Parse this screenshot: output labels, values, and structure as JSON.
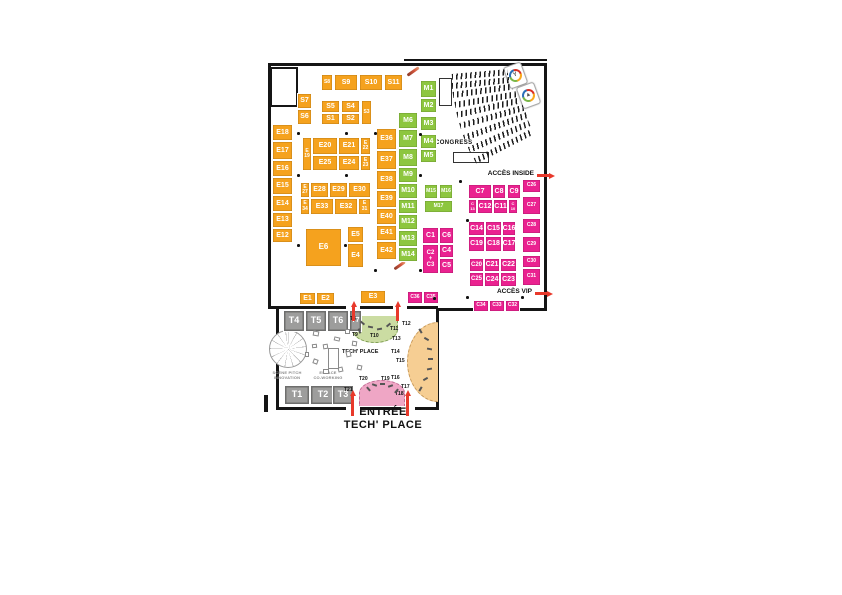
{
  "labels": {
    "congress": "CONGRESS",
    "acces_inside": "ACCÈS INSIDE",
    "acces_vip": "ACCÈS VIP",
    "tech_place": "TECH' PLACE",
    "scene_line1": "SCÈNE PITCH",
    "scene_line2": "INNOVATION",
    "cowork_line1": "ESPACE",
    "cowork_line2": "CO-WORKING",
    "entree_line1": "ENTRÉE",
    "entree_line2": "TECH' PLACE"
  },
  "icons": {
    "badge1": "Y",
    "badge2": "▲"
  },
  "colors": {
    "booth_orange": "#F5A21E",
    "booth_green": "#8DC63F",
    "booth_pink": "#EA2290",
    "booth_gray": "#9D9D9C",
    "zone_pale_green": "#CBDCA2",
    "zone_pale_orange": "#F6CE93",
    "zone_pale_pink": "#EFA6C5",
    "arrow_red": "#E8392B"
  },
  "booths": [
    {
      "id": "S8",
      "x": 321,
      "y": 74,
      "w": 12,
      "h": 17,
      "c": "orange",
      "lines": [
        "S8"
      ],
      "fs": 5
    },
    {
      "id": "S9",
      "label": "S9",
      "x": 334,
      "y": 74,
      "w": 24,
      "h": 17,
      "c": "orange"
    },
    {
      "id": "S10",
      "label": "S10",
      "x": 359,
      "y": 74,
      "w": 24,
      "h": 17,
      "c": "orange"
    },
    {
      "id": "S11",
      "label": "S11",
      "x": 384,
      "y": 74,
      "w": 19,
      "h": 17,
      "c": "orange"
    },
    {
      "id": "S7",
      "label": "S7",
      "x": 297,
      "y": 93,
      "w": 15,
      "h": 16,
      "c": "orange"
    },
    {
      "id": "S6",
      "label": "S6",
      "x": 297,
      "y": 109,
      "w": 15,
      "h": 16,
      "c": "orange"
    },
    {
      "id": "S5",
      "label": "S5",
      "x": 321,
      "y": 100,
      "w": 19,
      "h": 13,
      "c": "orange"
    },
    {
      "id": "S4",
      "label": "S4",
      "x": 341,
      "y": 100,
      "w": 19,
      "h": 13,
      "c": "orange"
    },
    {
      "id": "S3",
      "x": 361,
      "y": 100,
      "w": 11,
      "h": 25,
      "c": "orange",
      "lines": [
        "S3"
      ],
      "fs": 5
    },
    {
      "id": "S1",
      "label": "S1",
      "x": 321,
      "y": 113,
      "w": 19,
      "h": 12,
      "c": "orange"
    },
    {
      "id": "S2",
      "label": "S2",
      "x": 341,
      "y": 113,
      "w": 19,
      "h": 12,
      "c": "orange"
    },
    {
      "id": "E18",
      "label": "E18",
      "x": 272,
      "y": 124,
      "w": 21,
      "h": 17,
      "c": "orange"
    },
    {
      "id": "E17",
      "label": "E17",
      "x": 272,
      "y": 141,
      "w": 21,
      "h": 19,
      "c": "orange"
    },
    {
      "id": "E16",
      "label": "E16",
      "x": 272,
      "y": 160,
      "w": 21,
      "h": 17,
      "c": "orange"
    },
    {
      "id": "E15",
      "label": "E15",
      "x": 272,
      "y": 177,
      "w": 21,
      "h": 18,
      "c": "orange"
    },
    {
      "id": "E14",
      "label": "E14",
      "x": 272,
      "y": 195,
      "w": 21,
      "h": 17,
      "c": "orange"
    },
    {
      "id": "E13",
      "label": "E13",
      "x": 272,
      "y": 212,
      "w": 21,
      "h": 16,
      "c": "orange"
    },
    {
      "id": "E12",
      "label": "E12",
      "x": 272,
      "y": 228,
      "w": 21,
      "h": 15,
      "c": "orange"
    },
    {
      "id": "E19",
      "x": 302,
      "y": 137,
      "w": 10,
      "h": 34,
      "c": "orange",
      "lines": [
        "E",
        "19"
      ],
      "fs": 5
    },
    {
      "id": "E20",
      "label": "E20",
      "x": 312,
      "y": 137,
      "w": 26,
      "h": 18,
      "c": "orange"
    },
    {
      "id": "E21",
      "label": "E21",
      "x": 338,
      "y": 137,
      "w": 22,
      "h": 18,
      "c": "orange"
    },
    {
      "id": "E22",
      "x": 360,
      "y": 137,
      "w": 11,
      "h": 18,
      "c": "orange",
      "lines": [
        "E",
        "22"
      ],
      "fs": 5
    },
    {
      "id": "E25",
      "label": "E25",
      "x": 312,
      "y": 155,
      "w": 26,
      "h": 16,
      "c": "orange"
    },
    {
      "id": "E24",
      "label": "E24",
      "x": 338,
      "y": 155,
      "w": 22,
      "h": 16,
      "c": "orange"
    },
    {
      "id": "E23",
      "x": 360,
      "y": 155,
      "w": 11,
      "h": 16,
      "c": "orange",
      "lines": [
        "E",
        "23"
      ],
      "fs": 5
    },
    {
      "id": "E27",
      "x": 300,
      "y": 182,
      "w": 10,
      "h": 16,
      "c": "orange",
      "lines": [
        "E",
        "27"
      ],
      "fs": 5
    },
    {
      "id": "E28",
      "label": "E28",
      "x": 310,
      "y": 182,
      "w": 19,
      "h": 16,
      "c": "orange"
    },
    {
      "id": "E29",
      "label": "E29",
      "x": 329,
      "y": 182,
      "w": 19,
      "h": 16,
      "c": "orange"
    },
    {
      "id": "E30",
      "label": "E30",
      "x": 348,
      "y": 182,
      "w": 23,
      "h": 16,
      "c": "orange"
    },
    {
      "id": "E34",
      "x": 300,
      "y": 198,
      "w": 10,
      "h": 17,
      "c": "orange",
      "lines": [
        "E",
        "34"
      ],
      "fs": 5
    },
    {
      "id": "E33",
      "label": "E33",
      "x": 310,
      "y": 198,
      "w": 24,
      "h": 17,
      "c": "orange"
    },
    {
      "id": "E32",
      "label": "E32",
      "x": 334,
      "y": 198,
      "w": 24,
      "h": 17,
      "c": "orange"
    },
    {
      "id": "E31",
      "x": 358,
      "y": 198,
      "w": 13,
      "h": 17,
      "c": "orange",
      "lines": [
        "E",
        "31"
      ],
      "fs": 5
    },
    {
      "id": "E6",
      "label": "E6",
      "x": 305,
      "y": 228,
      "w": 37,
      "h": 39,
      "c": "orange",
      "fs": 8
    },
    {
      "id": "E5",
      "label": "E5",
      "x": 347,
      "y": 226,
      "w": 17,
      "h": 17,
      "c": "orange"
    },
    {
      "id": "E4",
      "label": "E4",
      "x": 347,
      "y": 243,
      "w": 17,
      "h": 25,
      "c": "orange"
    },
    {
      "id": "E36",
      "label": "E36",
      "x": 376,
      "y": 128,
      "w": 21,
      "h": 22,
      "c": "orange"
    },
    {
      "id": "E37",
      "label": "E37",
      "x": 376,
      "y": 150,
      "w": 21,
      "h": 20,
      "c": "orange"
    },
    {
      "id": "E38",
      "label": "E38",
      "x": 376,
      "y": 170,
      "w": 21,
      "h": 20,
      "c": "orange"
    },
    {
      "id": "E39",
      "label": "E39",
      "x": 376,
      "y": 190,
      "w": 21,
      "h": 18,
      "c": "orange"
    },
    {
      "id": "E40",
      "label": "E40",
      "x": 376,
      "y": 208,
      "w": 21,
      "h": 17,
      "c": "orange"
    },
    {
      "id": "E41",
      "label": "E41",
      "x": 376,
      "y": 225,
      "w": 21,
      "h": 16,
      "c": "orange"
    },
    {
      "id": "E42",
      "label": "E42",
      "x": 376,
      "y": 241,
      "w": 21,
      "h": 19,
      "c": "orange"
    },
    {
      "id": "E1",
      "label": "E1",
      "x": 299,
      "y": 292,
      "w": 17,
      "h": 13,
      "c": "orange"
    },
    {
      "id": "E2",
      "label": "E2",
      "x": 316,
      "y": 292,
      "w": 19,
      "h": 13,
      "c": "orange"
    },
    {
      "id": "E3",
      "label": "E3",
      "x": 360,
      "y": 290,
      "w": 26,
      "h": 14,
      "c": "orange"
    },
    {
      "id": "M6",
      "label": "M6",
      "x": 398,
      "y": 112,
      "w": 20,
      "h": 17,
      "c": "green"
    },
    {
      "id": "M7",
      "label": "M7",
      "x": 398,
      "y": 129,
      "w": 20,
      "h": 19,
      "c": "green"
    },
    {
      "id": "M8",
      "label": "M8",
      "x": 398,
      "y": 148,
      "w": 20,
      "h": 19,
      "c": "green"
    },
    {
      "id": "M9",
      "label": "M9",
      "x": 398,
      "y": 167,
      "w": 20,
      "h": 16,
      "c": "green"
    },
    {
      "id": "M10",
      "label": "M10",
      "x": 398,
      "y": 183,
      "w": 20,
      "h": 16,
      "c": "green"
    },
    {
      "id": "M11",
      "label": "M11",
      "x": 398,
      "y": 199,
      "w": 20,
      "h": 15,
      "c": "green"
    },
    {
      "id": "M12",
      "label": "M12",
      "x": 398,
      "y": 214,
      "w": 20,
      "h": 16,
      "c": "green"
    },
    {
      "id": "M13",
      "label": "M13",
      "x": 398,
      "y": 230,
      "w": 20,
      "h": 17,
      "c": "green"
    },
    {
      "id": "M14",
      "label": "M14",
      "x": 398,
      "y": 247,
      "w": 20,
      "h": 15,
      "c": "green"
    },
    {
      "id": "M1",
      "label": "M1",
      "x": 420,
      "y": 80,
      "w": 17,
      "h": 18,
      "c": "green"
    },
    {
      "id": "M2",
      "label": "M2",
      "x": 420,
      "y": 98,
      "w": 17,
      "h": 15,
      "c": "green"
    },
    {
      "id": "M3",
      "label": "M3",
      "x": 420,
      "y": 116,
      "w": 17,
      "h": 15,
      "c": "green"
    },
    {
      "id": "M4",
      "label": "M4",
      "x": 420,
      "y": 134,
      "w": 17,
      "h": 15,
      "c": "green"
    },
    {
      "id": "M5",
      "label": "M5",
      "x": 420,
      "y": 149,
      "w": 17,
      "h": 14,
      "c": "green"
    },
    {
      "id": "M15",
      "label": "M15",
      "x": 424,
      "y": 184,
      "w": 14,
      "h": 15,
      "c": "green",
      "fs": 5
    },
    {
      "id": "M16",
      "label": "M16",
      "x": 439,
      "y": 184,
      "w": 14,
      "h": 15,
      "c": "green",
      "fs": 5
    },
    {
      "id": "M17",
      "label": "M17",
      "x": 424,
      "y": 200,
      "w": 29,
      "h": 13,
      "c": "green",
      "fs": 5
    },
    {
      "id": "C7",
      "label": "C7",
      "x": 468,
      "y": 184,
      "w": 24,
      "h": 15,
      "c": "pink"
    },
    {
      "id": "C8",
      "label": "C8",
      "x": 492,
      "y": 184,
      "w": 14,
      "h": 15,
      "c": "pink"
    },
    {
      "id": "C9",
      "label": "C9",
      "x": 507,
      "y": 184,
      "w": 14,
      "h": 15,
      "c": "pink"
    },
    {
      "id": "C13",
      "x": 468,
      "y": 199,
      "w": 9,
      "h": 15,
      "c": "pink",
      "lines": [
        "C",
        "13"
      ],
      "fs": 4
    },
    {
      "id": "C12",
      "label": "C12",
      "x": 477,
      "y": 199,
      "w": 16,
      "h": 15,
      "c": "pink"
    },
    {
      "id": "C11",
      "label": "C11",
      "x": 493,
      "y": 199,
      "w": 15,
      "h": 15,
      "c": "pink"
    },
    {
      "id": "C10",
      "x": 508,
      "y": 199,
      "w": 10,
      "h": 15,
      "c": "pink",
      "lines": [
        "C",
        "10"
      ],
      "fs": 4
    },
    {
      "id": "C14",
      "label": "C14",
      "x": 468,
      "y": 221,
      "w": 17,
      "h": 15,
      "c": "pink"
    },
    {
      "id": "C15",
      "label": "C15",
      "x": 485,
      "y": 221,
      "w": 17,
      "h": 15,
      "c": "pink"
    },
    {
      "id": "C16",
      "label": "C16",
      "x": 502,
      "y": 221,
      "w": 14,
      "h": 15,
      "c": "pink"
    },
    {
      "id": "C19",
      "label": "C19",
      "x": 468,
      "y": 236,
      "w": 17,
      "h": 16,
      "c": "pink"
    },
    {
      "id": "C18",
      "label": "C18",
      "x": 485,
      "y": 236,
      "w": 17,
      "h": 16,
      "c": "pink"
    },
    {
      "id": "C17",
      "label": "C17",
      "x": 502,
      "y": 236,
      "w": 14,
      "h": 16,
      "c": "pink"
    },
    {
      "id": "C20",
      "label": "C20",
      "x": 469,
      "y": 258,
      "w": 15,
      "h": 14,
      "c": "pink",
      "fs": 6
    },
    {
      "id": "C21",
      "label": "C21",
      "x": 484,
      "y": 258,
      "w": 16,
      "h": 14,
      "c": "pink"
    },
    {
      "id": "C22",
      "label": "C22",
      "x": 500,
      "y": 258,
      "w": 17,
      "h": 14,
      "c": "pink"
    },
    {
      "id": "C25",
      "label": "C25",
      "x": 469,
      "y": 272,
      "w": 15,
      "h": 15,
      "c": "pink",
      "fs": 6
    },
    {
      "id": "C24",
      "label": "C24",
      "x": 484,
      "y": 272,
      "w": 16,
      "h": 15,
      "c": "pink"
    },
    {
      "id": "C23",
      "label": "C23",
      "x": 500,
      "y": 272,
      "w": 17,
      "h": 15,
      "c": "pink"
    },
    {
      "id": "C26",
      "label": "C26",
      "x": 522,
      "y": 179,
      "w": 19,
      "h": 14,
      "c": "pink",
      "fs": 5
    },
    {
      "id": "C27",
      "label": "C27",
      "x": 522,
      "y": 196,
      "w": 19,
      "h": 19,
      "c": "pink",
      "fs": 5
    },
    {
      "id": "C28",
      "label": "C28",
      "x": 522,
      "y": 218,
      "w": 19,
      "h": 16,
      "c": "pink",
      "fs": 5
    },
    {
      "id": "C29",
      "label": "C29",
      "x": 522,
      "y": 236,
      "w": 19,
      "h": 17,
      "c": "pink",
      "fs": 5
    },
    {
      "id": "C30",
      "label": "C30",
      "x": 522,
      "y": 255,
      "w": 19,
      "h": 13,
      "c": "pink",
      "fs": 5
    },
    {
      "id": "C31",
      "label": "C31",
      "x": 522,
      "y": 268,
      "w": 19,
      "h": 18,
      "c": "pink",
      "fs": 5
    },
    {
      "id": "C1",
      "label": "C1",
      "x": 422,
      "y": 227,
      "w": 17,
      "h": 17,
      "c": "pink"
    },
    {
      "id": "C6",
      "label": "C6",
      "x": 439,
      "y": 227,
      "w": 15,
      "h": 17,
      "c": "pink"
    },
    {
      "id": "C2-C3",
      "x": 422,
      "y": 244,
      "w": 17,
      "h": 30,
      "c": "pink",
      "lines": [
        "C2",
        "+",
        "C3"
      ],
      "fs": 6
    },
    {
      "id": "C4",
      "label": "C4",
      "x": 439,
      "y": 244,
      "w": 15,
      "h": 14,
      "c": "pink"
    },
    {
      "id": "C5",
      "label": "C5",
      "x": 439,
      "y": 258,
      "w": 15,
      "h": 16,
      "c": "pink"
    },
    {
      "id": "C36",
      "label": "C36",
      "x": 407,
      "y": 291,
      "w": 16,
      "h": 13,
      "c": "pink",
      "fs": 5
    },
    {
      "id": "C35",
      "label": "C35",
      "x": 423,
      "y": 291,
      "w": 16,
      "h": 13,
      "c": "pink",
      "fs": 5
    },
    {
      "id": "C34",
      "label": "C34",
      "x": 473,
      "y": 300,
      "w": 16,
      "h": 12,
      "c": "pink",
      "fs": 5
    },
    {
      "id": "C33",
      "label": "C33",
      "x": 489,
      "y": 300,
      "w": 16,
      "h": 12,
      "c": "pink",
      "fs": 5
    },
    {
      "id": "C32",
      "label": "C32",
      "x": 505,
      "y": 300,
      "w": 15,
      "h": 12,
      "c": "pink",
      "fs": 5
    },
    {
      "id": "T4",
      "label": "T4",
      "x": 283,
      "y": 310,
      "w": 22,
      "h": 22,
      "c": "gray",
      "fs": 9
    },
    {
      "id": "T5",
      "label": "T5",
      "x": 305,
      "y": 310,
      "w": 22,
      "h": 22,
      "c": "gray",
      "fs": 9
    },
    {
      "id": "T6",
      "label": "T6",
      "x": 327,
      "y": 310,
      "w": 22,
      "h": 22,
      "c": "gray",
      "fs": 9
    },
    {
      "id": "T7",
      "label": "T7",
      "x": 349,
      "y": 310,
      "w": 13,
      "h": 22,
      "c": "gray",
      "fs": 7
    },
    {
      "id": "T1",
      "label": "T1",
      "x": 284,
      "y": 385,
      "w": 26,
      "h": 20,
      "c": "gray",
      "fs": 9
    },
    {
      "id": "T2",
      "label": "T2",
      "x": 310,
      "y": 385,
      "w": 26,
      "h": 20,
      "c": "gray",
      "fs": 9
    },
    {
      "id": "T3",
      "label": "T3",
      "x": 332,
      "y": 385,
      "w": 22,
      "h": 20,
      "c": "gray",
      "fs": 9
    }
  ],
  "t_labels": [
    {
      "id": "T8",
      "x": 350,
      "y": 316
    },
    {
      "id": "T9",
      "x": 352,
      "y": 332
    },
    {
      "id": "T10",
      "x": 370,
      "y": 333
    },
    {
      "id": "T11",
      "x": 390,
      "y": 326
    },
    {
      "id": "T12",
      "x": 402,
      "y": 321
    },
    {
      "id": "T13",
      "x": 392,
      "y": 336
    },
    {
      "id": "T14",
      "x": 391,
      "y": 349
    },
    {
      "id": "T15",
      "x": 396,
      "y": 358
    },
    {
      "id": "T16",
      "x": 391,
      "y": 375
    },
    {
      "id": "T17",
      "x": 401,
      "y": 384
    },
    {
      "id": "T18",
      "x": 395,
      "y": 391
    },
    {
      "id": "T19",
      "x": 381,
      "y": 376
    },
    {
      "id": "T20",
      "x": 359,
      "y": 376
    },
    {
      "id": "T21",
      "x": 344,
      "y": 387
    }
  ],
  "arrows": [
    {
      "dir": "up",
      "x": 350,
      "y": 301,
      "len": 20
    },
    {
      "dir": "up",
      "x": 394,
      "y": 301,
      "len": 20
    },
    {
      "dir": "up",
      "x": 349,
      "y": 390,
      "len": 26
    },
    {
      "dir": "up",
      "x": 404,
      "y": 390,
      "len": 26
    },
    {
      "dir": "right",
      "x": 537,
      "y": 172,
      "len": 18
    },
    {
      "dir": "right",
      "x": 535,
      "y": 290,
      "len": 18
    }
  ]
}
